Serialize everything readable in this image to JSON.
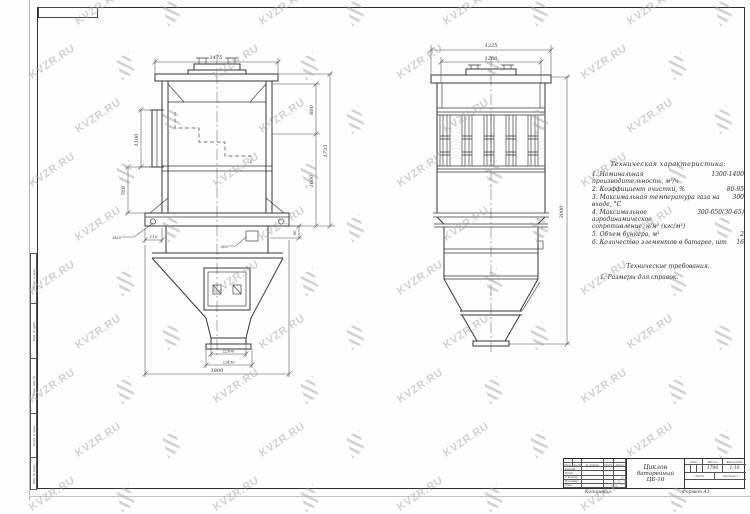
{
  "watermark": {
    "text": "KVZR.RU"
  },
  "colors": {
    "ink": "#383838",
    "watermark": "#a9a9a9",
    "paper": "#fdfdfd"
  },
  "frame": {
    "copied_label": "Копировал",
    "format_label": "Формат А1"
  },
  "side_strip": {
    "cells": [
      "Подп. и дата",
      "Инв. № дубл.",
      "Взам. инв. №",
      "Подп. и дата",
      "Инв. № подл."
    ]
  },
  "dims": {
    "lv_width": "1475",
    "lv_right_upper": "600",
    "lv_right_mid": "1600",
    "lv_right_total": "1735",
    "lv_left_inlet": "1100",
    "lv_left_lower": "700",
    "lv_hole": "Ø30",
    "lv_base_offset": "110",
    "lv_hatch": "300",
    "lv_small_right": "90",
    "lv_out_inner": "□300",
    "lv_out_outer": "□450",
    "lv_base_width": "1800",
    "rv_width_outer": "1325",
    "rv_width_inner": "1200",
    "rv_height": "3000"
  },
  "specs": {
    "title": "Техническая характеристика:",
    "items": [
      {
        "text": "1. Номинальная производительность, м³/ч",
        "value": "1300-1400"
      },
      {
        "text": "2. Коэффициент очистки, %",
        "value": "80-95"
      },
      {
        "text": "3. Максимальная температура газа на входе, °С",
        "value": "300"
      },
      {
        "text": "4. Максимальное аэродинамическое сопротивление, н/м² (кгс/м²)",
        "value": "300-650(30-65)"
      },
      {
        "text": "5. Объем бункера, м³",
        "value": "2"
      },
      {
        "text": "6. Количество элементов в батарее, шт",
        "value": "16"
      }
    ],
    "requirements_title": "Технические требования.",
    "requirements": [
      "1. Размеры для справок."
    ]
  },
  "title_block": {
    "doc_name_line1": "Циклон",
    "doc_name_line2": "батарейный",
    "doc_name_line3": "ЦБ-16",
    "header_cols": [
      "Изм.",
      "Лист",
      "№ докум.",
      "Подп.",
      "Дата"
    ],
    "rows": [
      "Разраб.",
      "Пров.",
      "Т.контр.",
      "Н.контр.",
      "Утв."
    ],
    "lit_label": "Лит.",
    "mass_label": "Масса",
    "scale_label": "Масштаб",
    "mass_value": "1790",
    "scale_value": "1:10",
    "sheet_label": "Лист",
    "sheets_label": "Листов 1"
  }
}
